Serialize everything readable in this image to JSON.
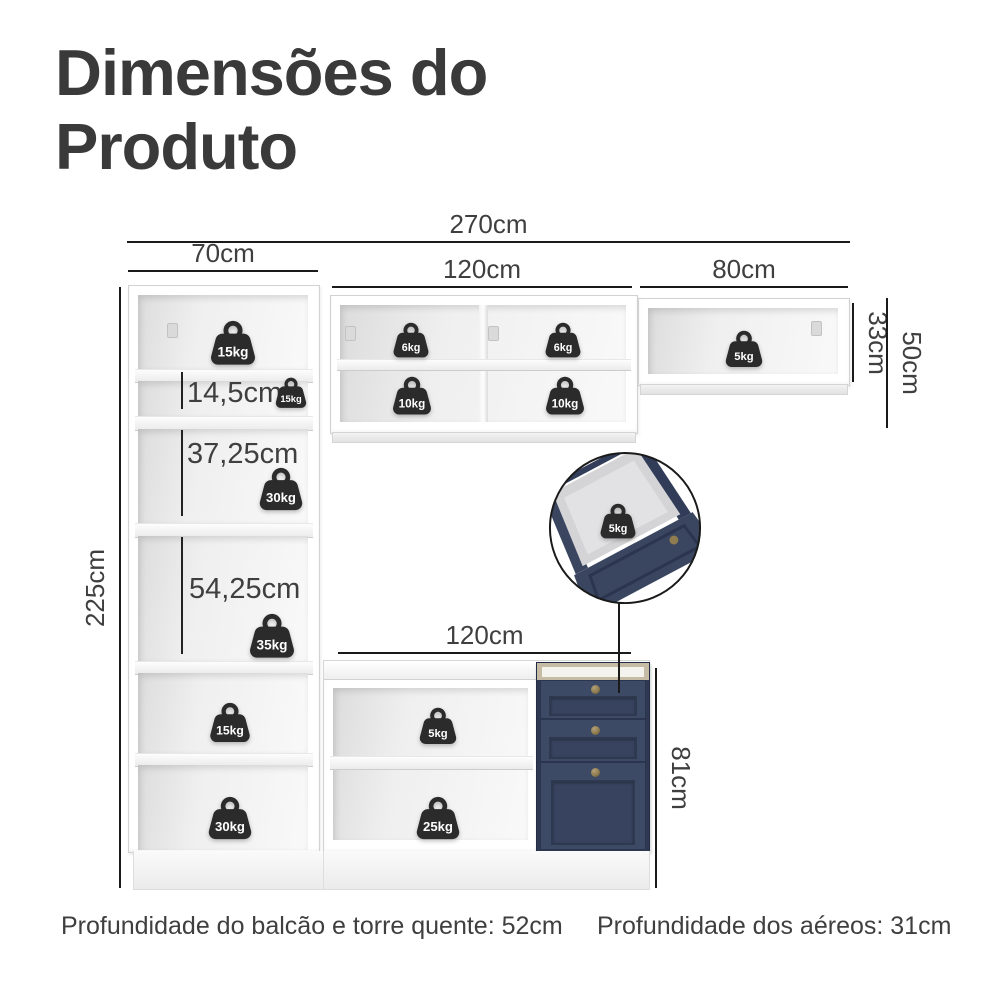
{
  "title": {
    "line1": "Dimensões do",
    "line2": "Produto"
  },
  "dimensions": {
    "total_width": "270cm",
    "tower_width": "70cm",
    "upper_cabinet_width": "120cm",
    "aerial_right_width": "80cm",
    "aerial_right_height": "33cm",
    "aerial_height": "50cm",
    "total_height": "225cm",
    "shelf_small_height": "14,5cm",
    "shelf_middle_height": "37,25cm",
    "shelf_large_height": "54,25cm",
    "counter_width": "120cm",
    "counter_height": "81cm"
  },
  "weights": {
    "tower_top": "15kg",
    "tower_shelf_small": "15kg",
    "tower_shelf_middle": "30kg",
    "tower_shelf_large": "35kg",
    "upper_cabinet_top_left": "6kg",
    "upper_cabinet_top_right": "6kg",
    "upper_cabinet_bottom_left": "10kg",
    "upper_cabinet_bottom_right": "10kg",
    "aerial_right_cabinet": "5kg",
    "drawer_detail": "5kg",
    "tower_lower_top": "15kg",
    "tower_lower_bottom": "30kg",
    "counter_shelf_top": "5kg",
    "counter_shelf_bottom": "25kg"
  },
  "footer": {
    "counter_depth": "Profundidade do balcão e torre quente: 52cm",
    "aerial_depth": "Profundidade dos aéreos: 31cm"
  },
  "colors": {
    "navy": "#3a4560",
    "navy_dark": "#2e3850",
    "countertop_tan": "#c6bca6",
    "knob_gold": "#8f7c50",
    "weight_fill": "#2b2b2b",
    "dimension_line": "#1a1a1a",
    "text": "#3f3f3f",
    "title_text": "#3a3a3a"
  }
}
